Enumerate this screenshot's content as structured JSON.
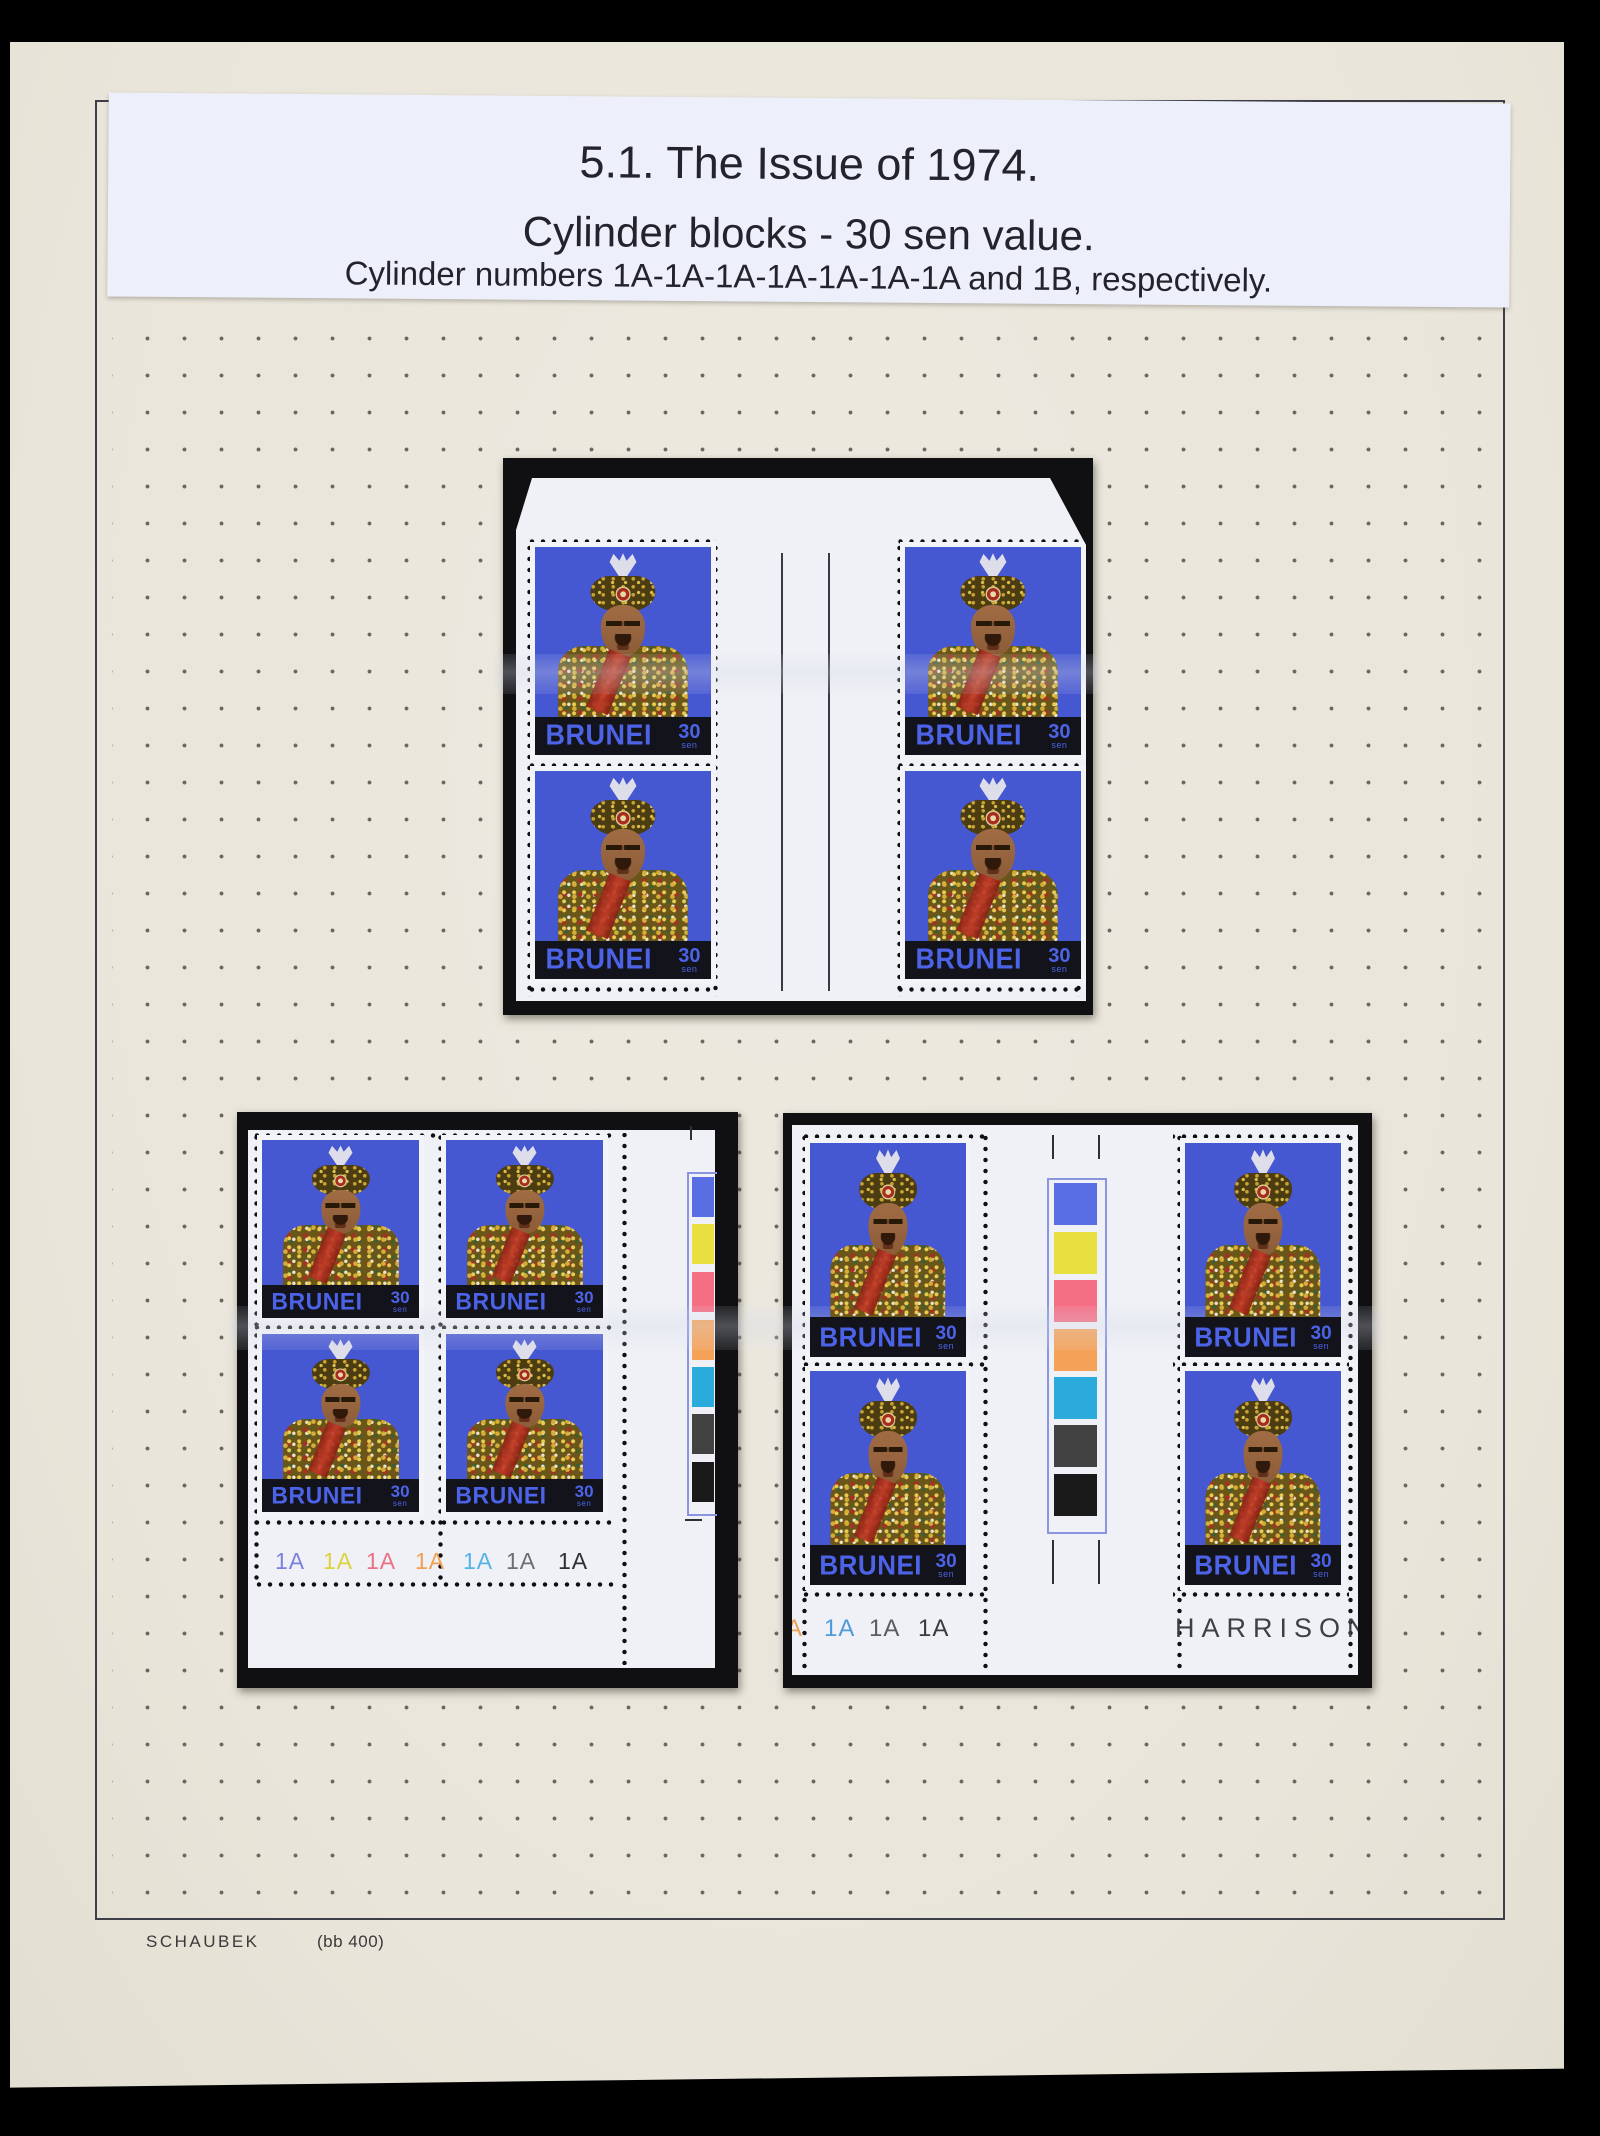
{
  "header": {
    "line1": "5.1. The Issue of 1974.",
    "line2": "Cylinder blocks - 30 sen value.",
    "line3": "Cylinder numbers 1A-1A-1A-1A-1A-1A-1A and 1B, respectively."
  },
  "stamp": {
    "country": "BRUNEI",
    "value": "30",
    "unit": "sen"
  },
  "blocks": {
    "bottom_left": {
      "cylinder_numbers": [
        {
          "text": "1A",
          "color": "#7b82dd"
        },
        {
          "text": "1A",
          "color": "#ddd23e"
        },
        {
          "text": "1A",
          "color": "#ee7086"
        },
        {
          "text": "1A",
          "color": "#f0a052"
        },
        {
          "text": "1A",
          "color": "#55b2e6"
        },
        {
          "text": "1A",
          "color": "#6e6e70"
        },
        {
          "text": "1A",
          "color": "#303034"
        }
      ],
      "traffic_lights": [
        "#5a6ee4",
        "#e8e040",
        "#f46e84",
        "#f4a258",
        "#2aabdc",
        "#424242",
        "#1a1a1a"
      ]
    },
    "bottom_right": {
      "cylinder_numbers": [
        {
          "text": "A",
          "color": "#f0a052"
        },
        {
          "text": "1A",
          "color": "#4f9ad8"
        },
        {
          "text": "1A",
          "color": "#5c5c60"
        },
        {
          "text": "1A",
          "color": "#3a3a3e"
        }
      ],
      "printer": "HARRISON",
      "traffic_lights": [
        "#5a6ee4",
        "#e8e040",
        "#f46e84",
        "#f4a258",
        "#2aabdc",
        "#424242",
        "#1a1a1a"
      ]
    }
  },
  "footer": {
    "publisher": "SCHAUBEK",
    "code": "(bb 400)"
  },
  "colors": {
    "stamp_blue": "#4657d2",
    "stamp_text_blue": "#4c63e8",
    "band_black": "#13131b",
    "mount_black": "#101012",
    "page_cream": "#ebe7dd",
    "sheet_white": "#eff1f6",
    "label_white": "#edeffa"
  }
}
